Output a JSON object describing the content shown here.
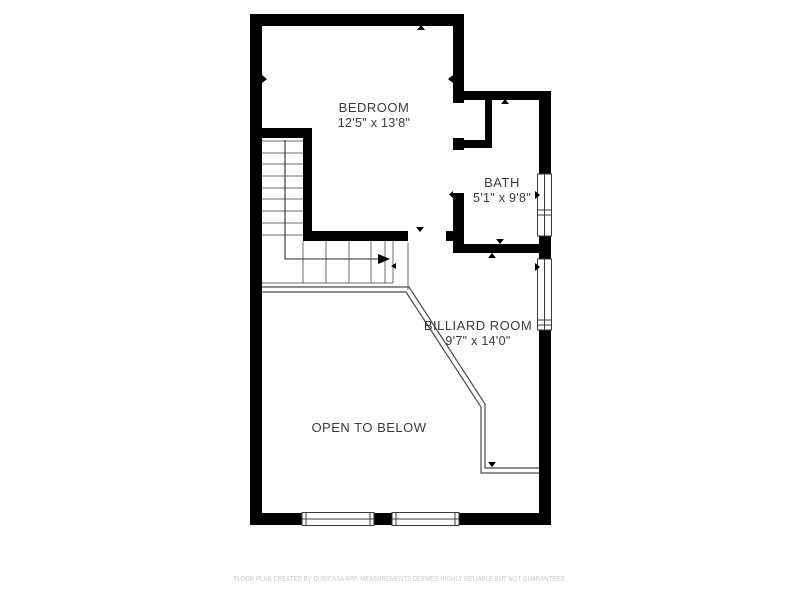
{
  "floor_plan": {
    "rooms": [
      {
        "id": "bedroom",
        "name": "BEDROOM",
        "dimensions": "12'5\" x 13'8\""
      },
      {
        "id": "bath",
        "name": "BATH",
        "dimensions": "5'1\" x 9'8\""
      },
      {
        "id": "billiard_room",
        "name": "BILLIARD ROOM",
        "dimensions": "9'7\" x 14'0\""
      },
      {
        "id": "open_to_below",
        "name": "OPEN TO BELOW"
      }
    ],
    "stair_direction": "up",
    "footer": {
      "disclaimer": "FLOOR PLAN CREATED BY CUBICASA APP. MEASUREMENTS DEEMED HIGHLY RELIABLE BUT NOT GUARANTEED."
    },
    "colors": {
      "wall": "#000000",
      "background": "#ffffff",
      "window_frame": "#3a3a3a",
      "stair_line": "#6e6e6e",
      "arrow_line": "#2b2b2b",
      "railing_line": "#4a4a4a",
      "label_text": "#3a3a3a",
      "footer_text": "#c6c6c6"
    }
  }
}
